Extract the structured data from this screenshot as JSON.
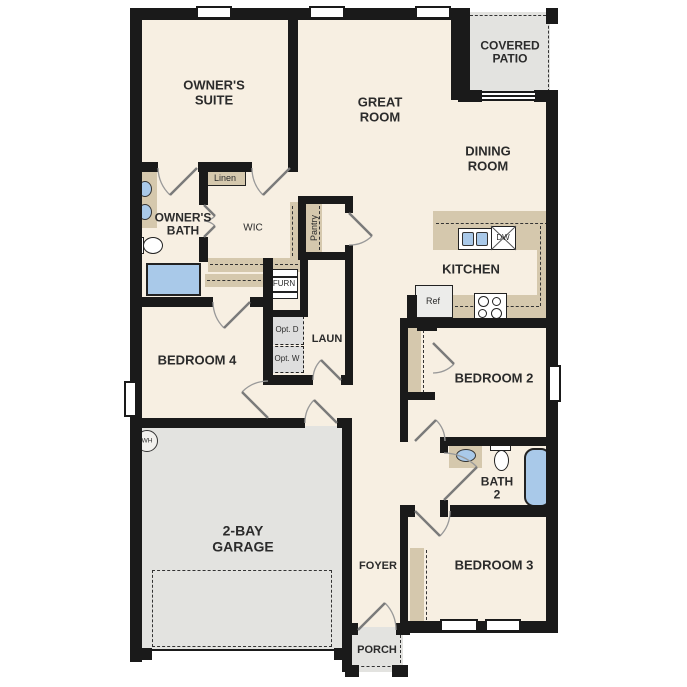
{
  "colors": {
    "floor": "#f7efe2",
    "counter_tan": "#d5c8ad",
    "outdoor_gray": "#e3e3e0",
    "fixture_blue": "#a9c9e9",
    "wall": "#1a1a1a"
  },
  "rooms": {
    "owners_suite": "OWNER'S SUITE",
    "great_room": "GREAT ROOM",
    "covered_patio": "COVERED PATIO",
    "dining_room": "DINING ROOM",
    "kitchen": "KITCHEN",
    "owners_bath": "OWNER'S BATH",
    "wic": "WIC",
    "linen": "Linen",
    "pantry": "Pantry",
    "furnace": "FURN",
    "laundry": "LAUN",
    "opt_dryer": "Opt. D",
    "opt_washer": "Opt. W",
    "bedroom_4": "BEDROOM 4",
    "bedroom_2": "BEDROOM 2",
    "bath_2": "BATH 2",
    "bedroom_3": "BEDROOM 3",
    "foyer": "FOYER",
    "porch": "PORCH",
    "garage": "2-BAY GARAGE"
  },
  "fixtures": {
    "water_heater": "WH",
    "refrigerator": "Ref",
    "dishwasher": "DW"
  }
}
